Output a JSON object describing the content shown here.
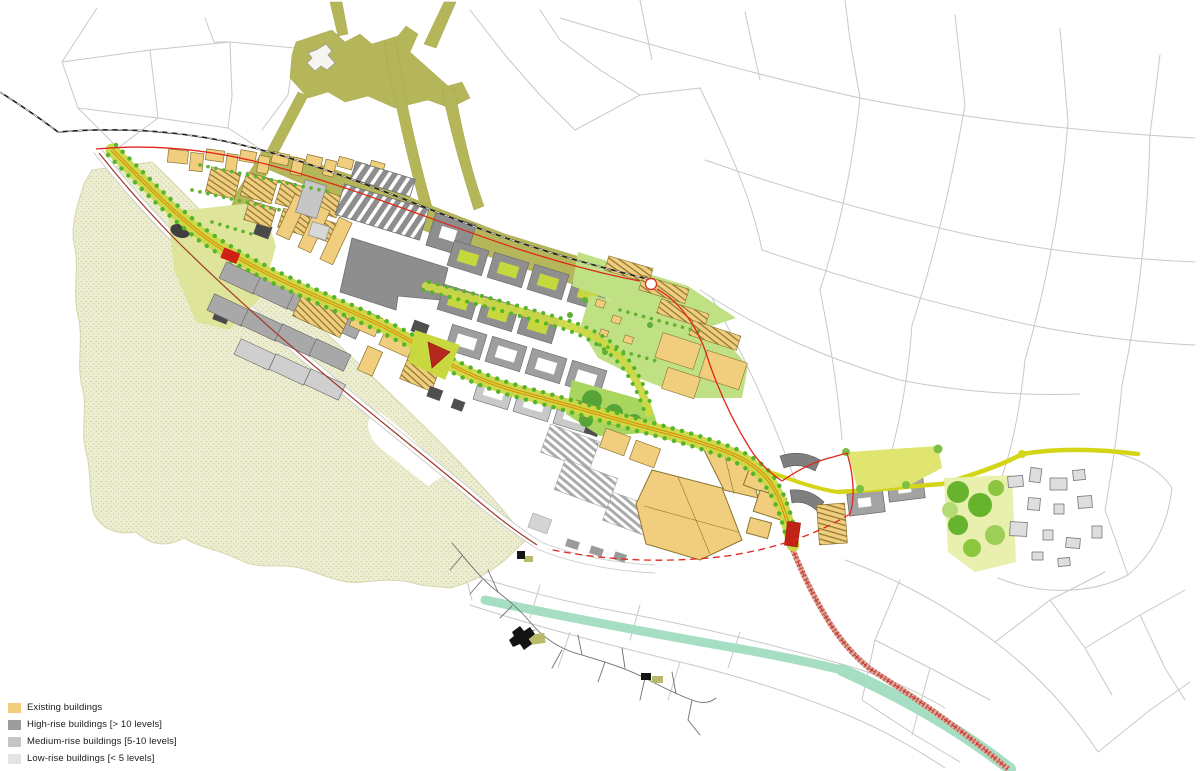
{
  "legend": {
    "items": [
      {
        "label": "Existing buildings",
        "color": "#F0CE7A",
        "swatch_style": "background:#F0CE7A"
      },
      {
        "label": "High-rise buildings [> 10 levels]",
        "color": "#9C9C9C",
        "swatch_style": "background:#9C9C9C"
      },
      {
        "label": "Medium-rise buildings [5-10 levels]",
        "color": "#C5C5C5",
        "swatch_style": "background:#C5C5C5"
      },
      {
        "label": "Low-rise buildings [< 5 levels]",
        "color": "#E4E4E4",
        "swatch_style": "background:#E4E4E4"
      }
    ]
  },
  "map": {
    "type": "urban masterplan",
    "colors": {
      "existing_buildings": "#F0CE7A",
      "high_rise": "#9C9C9C",
      "medium_rise": "#C5C5C5",
      "low_rise": "#E4E4E4",
      "courtyard_green": "#C5D83E",
      "residential_green": "#BFE083",
      "forest_stipple": "#EDEDD2",
      "historic_route_olive": "#B5B55A",
      "axis_orange": "#E08C00",
      "tree_dot_green": "#54B42A",
      "boundary_red": "#E0261C",
      "landmark_red": "#C22318",
      "river_mint": "#A5DEC2",
      "link_road_yellow": "#D4D516",
      "railway_black": "#1C1C1C",
      "street_outline_gray": "#C8C8C8"
    }
  }
}
